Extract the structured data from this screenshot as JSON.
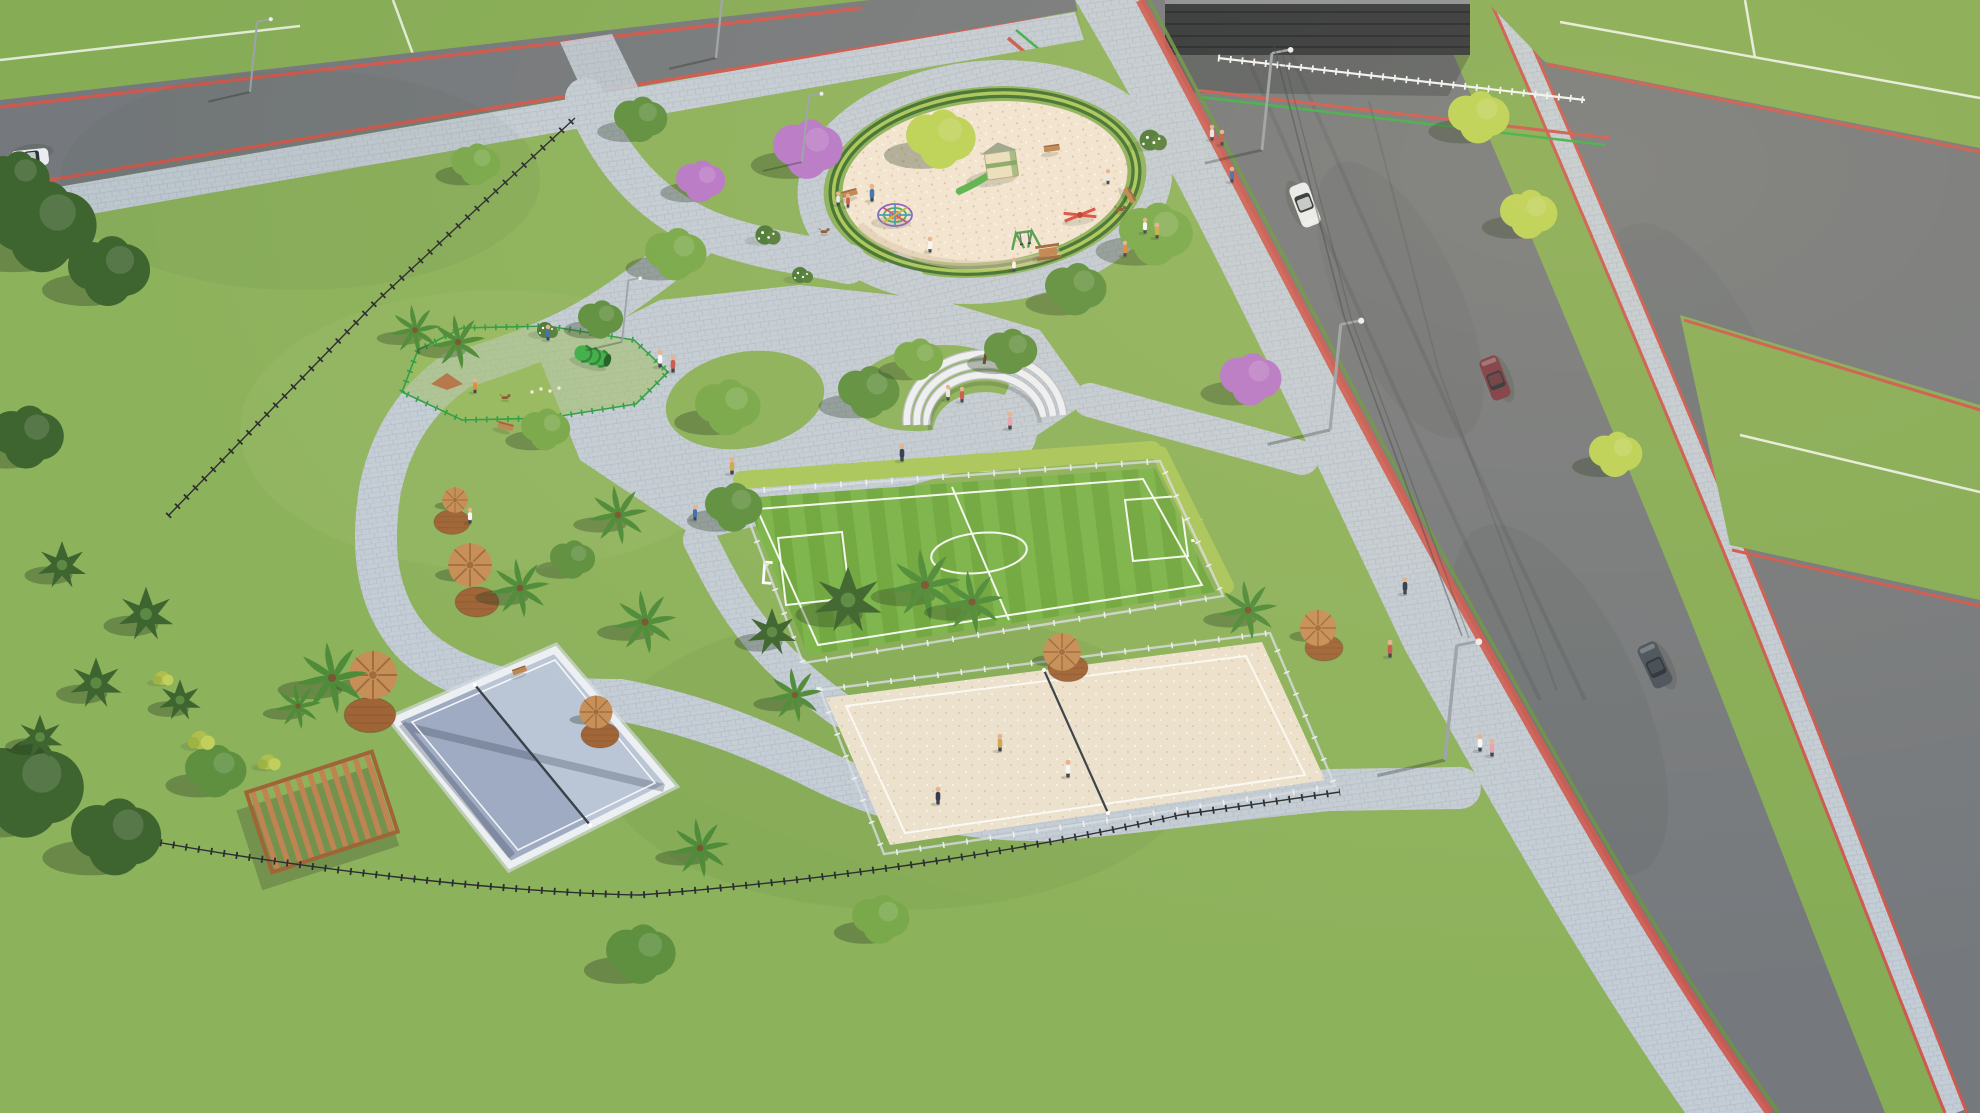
{
  "scene": {
    "title": "Aerial 3D render of a neighborhood leisure park at golden hour",
    "description": "High oblique drone view of a community park: circular sand playground with play structures, fenced dog agility area, curved white seat-wall plaza, fenced synthetic-turf soccer field with green hedge wall, fenced beach sand court, white-walled padel court, timber pergola, thatched palm umbrellas on round wood decks, winding paver promenades, black perimeter fence, and surrounding asphalt streets with red edge lanes, sidewalks, cars and pedestrians.",
    "time_of_day": "late afternoon",
    "visible_text": "none"
  },
  "areas": [
    {
      "id": "playground",
      "label": "circular sand playground"
    },
    {
      "id": "dog-park",
      "label": "fenced dog agility area"
    },
    {
      "id": "plaza",
      "label": "amphitheater seat-wall plaza"
    },
    {
      "id": "soccer-field",
      "label": "synthetic turf soccer field"
    },
    {
      "id": "beach-court",
      "label": "beach sand sports court"
    },
    {
      "id": "padel-court",
      "label": "white-walled padel court"
    },
    {
      "id": "pergola",
      "label": "timber pergola"
    },
    {
      "id": "promenade",
      "label": "paver promenade with thatch umbrellas"
    },
    {
      "id": "streets",
      "label": "asphalt streets with red edge lanes"
    }
  ],
  "inventory": {
    "cars": [
      {
        "body": "white-suv",
        "location": "main road upper"
      },
      {
        "body": "maroon-sedan",
        "location": "main road middle"
      },
      {
        "body": "dark-suv",
        "location": "lower crossroads"
      },
      {
        "body": "white-car",
        "location": "left road"
      }
    ],
    "thatch_umbrellas": 6,
    "wood_decks": 6,
    "palm_trees": 12,
    "purple_ipe_trees": 3,
    "lime_trees": 4,
    "araucaria_trees": 7,
    "benches": 4,
    "picnic_tables": 1,
    "street_lights": 7,
    "pedestrians_approx": 27,
    "dogs": 3
  },
  "colors": {
    "grass": "#86ac56",
    "grassDark": "#6a9445",
    "grassPark": "#8db25c",
    "grassLight": "#9dbf66",
    "asphalt": "#75797d",
    "asphaltDark": "#5f6367",
    "paver": "#c4cdd6",
    "paverShade": "#a9b4c0",
    "paverLight": "#d8dee5",
    "redLane": "#cd594f",
    "stripeGreen": "#3fae4a",
    "sandPlay": "#f2e5d3",
    "sandBeach": "#ece1cd",
    "sandShade": "#d9c5ac",
    "turf": "#6fa73f",
    "turfStripe": "#7bb44b",
    "hedge": "#a9c75b",
    "thatch": "#c78f58",
    "thatchDark": "#9f6c3e",
    "wood": "#a06537",
    "woodLight": "#bf8451",
    "woodDark": "#7c4e28",
    "courtFloor": "#9fabc2",
    "courtFloorLight": "#bac6d6",
    "wallWhite": "#edf0f3",
    "mesh": "#d6dde3",
    "fenceBlack": "#2b2e30",
    "fenceGreen": "#2f9e46",
    "treeGreen": "#5f9040",
    "treeGreen2": "#79a94b",
    "treeDark": "#3e652f",
    "treeLime": "#bcd255",
    "treePurple": "#b878c8",
    "palmGreen": "#4f8c3a",
    "carWhite": "#e9edef",
    "carMaroon": "#7c3a45",
    "carDark": "#49525c",
    "glass": "#2c3238",
    "skin": "#e6b28d",
    "poleGray": "#9aa2a8",
    "person1": "#3f6fb0",
    "person2": "#e8e8e8",
    "person3": "#c9584d",
    "person4": "#2e3b4e",
    "person5": "#e08a3c",
    "person6": "#e6a1b1",
    "person7": "#f7f7f7",
    "person8": "#caa94f"
  }
}
